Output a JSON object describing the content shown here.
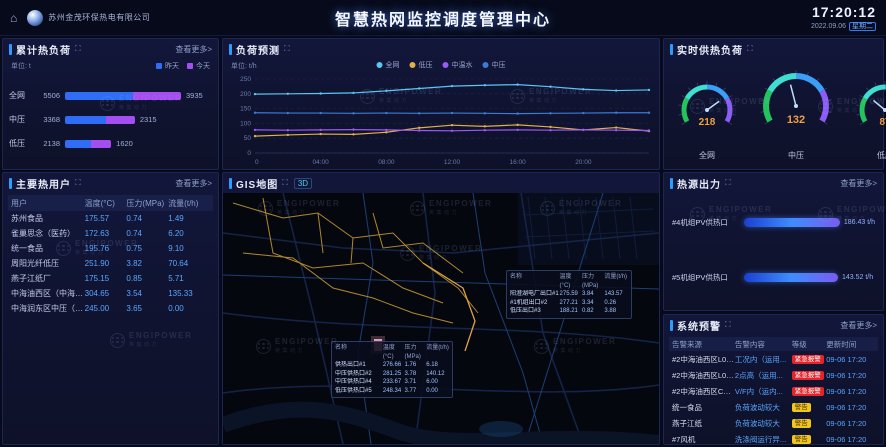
{
  "header": {
    "company": "苏州金茂环保热电有限公司",
    "title": "智慧热网监控调度管理中心",
    "clock": "17:20:12",
    "date": "2022.09.06",
    "weekday": "星期二"
  },
  "watermark": {
    "text": "ENGIPOWER",
    "subtext": "英集动力"
  },
  "chart_data": {
    "type": "line",
    "title": "负荷预测",
    "unit": "单位: t/h",
    "x_hours": [
      0,
      2,
      4,
      6,
      8,
      10,
      12,
      14,
      16,
      18,
      20,
      22,
      24
    ],
    "x_tick_hours": [
      0,
      4,
      8,
      12,
      16,
      20
    ],
    "x_tick_labels": [
      "0",
      "04:00",
      "08:00",
      "12:00",
      "16:00",
      "20:00"
    ],
    "ylim": [
      0,
      250
    ],
    "yticks": [
      0,
      50,
      100,
      150,
      200,
      250
    ],
    "legend_position": "top",
    "grid": true,
    "series": [
      {
        "name": "全网",
        "color": "#5bc5f2",
        "values": [
          199,
          200,
          201,
          203,
          210,
          218,
          226,
          229,
          231,
          224,
          215,
          211,
          213
        ]
      },
      {
        "name": "低压",
        "color": "#e2b04a",
        "values": [
          57,
          61,
          64,
          63,
          70,
          85,
          94,
          90,
          95,
          88,
          78,
          86,
          74
        ]
      },
      {
        "name": "中温水",
        "color": "#9b59f6",
        "values": [
          78,
          77,
          78,
          79,
          78,
          76,
          75,
          77,
          78,
          77,
          78,
          77,
          76
        ]
      },
      {
        "name": "中压",
        "color": "#3a7bd5",
        "values": [
          136,
          135,
          135,
          134,
          135,
          134,
          135,
          134,
          133,
          134,
          135,
          136,
          136
        ]
      }
    ]
  },
  "panels": {
    "cumulative": {
      "title": "累计热负荷",
      "more": "查看更多>",
      "unit": "单位: t",
      "legend": [
        {
          "label": "昨天",
          "color": "#2f6df6"
        },
        {
          "label": "今天",
          "color": "#a44df0"
        }
      ],
      "rows": [
        {
          "label": "全网",
          "yesterday": 5506,
          "today": 3935
        },
        {
          "label": "中压",
          "yesterday": 3368,
          "today": 2315
        },
        {
          "label": "低压",
          "yesterday": 2138,
          "today": 1620
        }
      ]
    },
    "forecast": {
      "title": "负荷预测",
      "unit": "单位: t/h"
    },
    "gauges": {
      "title": "实时供热负荷",
      "max": 300,
      "value_color": "#f0a13c",
      "items": [
        {
          "label": "全网",
          "value": 218
        },
        {
          "label": "中压",
          "value": 132
        },
        {
          "label": "低压",
          "value": 87
        }
      ]
    },
    "users": {
      "title": "主要热用户",
      "more": "查看更多>",
      "columns": [
        "用户",
        "温度(°C)",
        "压力(MPa)",
        "流量(t/h)"
      ],
      "rows": [
        {
          "name": "苏州食品",
          "temp": "175.57",
          "press": "0.74",
          "flow": "1.49"
        },
        {
          "name": "雀巢思念（医药）",
          "temp": "172.63",
          "press": "0.74",
          "flow": "6.20"
        },
        {
          "name": "统一食品",
          "temp": "195.76",
          "press": "0.75",
          "flow": "9.10"
        },
        {
          "name": "周阳光纤低压",
          "temp": "251.90",
          "press": "3.82",
          "flow": "70.64"
        },
        {
          "name": "燕子江纸厂",
          "temp": "175.15",
          "press": "0.85",
          "flow": "5.71"
        },
        {
          "name": "中海油西区（中海油）",
          "temp": "304.65",
          "press": "3.54",
          "flow": "135.33"
        },
        {
          "name": "中海润东区中压（预）",
          "temp": "245.00",
          "press": "3.65",
          "flow": "0.00"
        }
      ]
    },
    "gis": {
      "title": "GIS地图",
      "mode_3d": "3D",
      "tooltips": [
        {
          "columns": [
            "名称",
            "温度(°C)",
            "压力(MPa)",
            "流量(t/h)"
          ],
          "rows": [
            {
              "name": "阳澄湖电厂出口#1",
              "temp": "275.59",
              "press": "3.84",
              "flow": "143.57"
            },
            {
              "name": "#1机组出口#2",
              "temp": "277.21",
              "press": "3.34",
              "flow": "0.26"
            },
            {
              "name": "低压出口#3",
              "temp": "188.21",
              "press": "0.82",
              "flow": "3.88"
            }
          ]
        },
        {
          "columns": [
            "名称",
            "温度(°C)",
            "压力(MPa)",
            "流量(t/h)"
          ],
          "rows": [
            {
              "name": "供热出口#1",
              "temp": "276.66",
              "press": "1.76",
              "flow": "6.18"
            },
            {
              "name": "中压供热口#2",
              "temp": "281.25",
              "press": "3.78",
              "flow": "140.12"
            },
            {
              "name": "中压供热口#4",
              "temp": "233.67",
              "press": "3.71",
              "flow": "6.00"
            },
            {
              "name": "低压供热口#5",
              "temp": "248.34",
              "press": "3.77",
              "flow": "0.00"
            }
          ]
        }
      ]
    },
    "source": {
      "title": "热源出力",
      "more": "查看更多>",
      "max": 200,
      "bars": [
        {
          "label": "#4机组PV供热口",
          "value": 186.43,
          "display": "186.43 t/h"
        },
        {
          "label": "#5机组PV供热口",
          "value": 143.52,
          "display": "143.52 t/h"
        }
      ]
    },
    "alerts": {
      "title": "系统预警",
      "more": "查看更多>",
      "columns": [
        "告警来源",
        "告警内容",
        "等级",
        "更新时间"
      ],
      "levels": {
        "danger": {
          "label": "紧急报警",
          "color": "#e3242b"
        },
        "warning": {
          "label": "警告",
          "color": "#f0c51c"
        }
      },
      "rows": [
        {
          "source": "#2中海油西区L0锅...",
          "content": "工况内（运用...",
          "level": "danger",
          "time": "09-06 17:20"
        },
        {
          "source": "#2中海油西区L0锅...",
          "content": "2点高（运用...",
          "level": "danger",
          "time": "09-06 17:20"
        },
        {
          "source": "#2中海油西区CO排...",
          "content": "V/F内（运内...",
          "level": "danger",
          "time": "09-06 17:20"
        },
        {
          "source": "统一食品",
          "content": "负荷波动较大",
          "level": "warning",
          "time": "09-06 17:20"
        },
        {
          "source": "燕子江纸",
          "content": "负荷波动较大",
          "level": "warning",
          "time": "09-06 17:20"
        },
        {
          "source": "#7风机",
          "content": "洗涤阀运行异...",
          "level": "warning",
          "time": "09-06 17:20"
        }
      ]
    }
  }
}
